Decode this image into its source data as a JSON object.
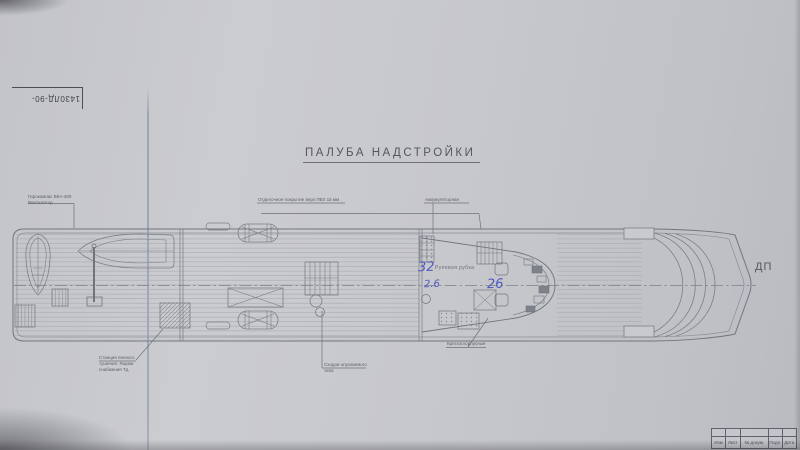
{
  "title": "ПАЛУБА НАДСТРОЙКИ",
  "drawing_number": "1430ЛД-90-",
  "centerplane_label": "ДП",
  "annotations": {
    "pedestal": {
      "line1": "Гирокомпас ВКА-300",
      "line2": "Вентилятор"
    },
    "deck_covering": "Отделочное покрытие верх ПВХ 15 мм",
    "battery_room": "Аккумуляторная",
    "wheelhouse": "Рулевая рубка",
    "foam_station": {
      "line1": "Станция пенного",
      "line2": "тушения. Ящики",
      "line3": "снабжения Тд"
    },
    "gangway": {
      "line1": "Сходни опускаемого",
      "line2": "типа"
    },
    "seats": "Кресла корпусные"
  },
  "handwritten": {
    "wheelhouse_number": "32",
    "left_value": "2.6",
    "center_value": "26"
  },
  "title_block": {
    "cells": [
      "Изм",
      "Лист",
      "№ докум.",
      "Подп.",
      "Дата"
    ]
  },
  "colors": {
    "paper": "#c7c8cc",
    "ink": "#70757c",
    "handwriting_blue": "#4f58c0"
  }
}
